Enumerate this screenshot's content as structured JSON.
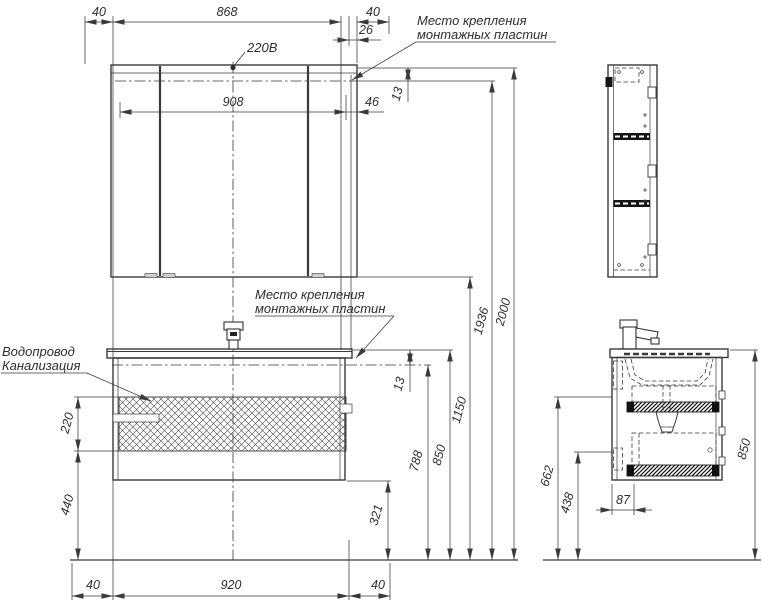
{
  "drawing": {
    "labels": {
      "power": "220В",
      "mounting_top_line1": "Место крепления",
      "mounting_top_line2": "монтажных пластин",
      "mounting_mid_line1": "Место крепления",
      "mounting_mid_line2": "монтажных пластин",
      "water": "Водопровод",
      "sewer": "Канализация"
    },
    "front": {
      "top": {
        "margin_left": "40",
        "plate_span": "868",
        "margin_right": "40",
        "offset": "26",
        "gap": "13",
        "inner_width": "908",
        "side_offset": "46"
      },
      "left": {
        "zone_height": "220",
        "zone_bottom": "440"
      },
      "bottom": {
        "margin_left": "40",
        "width": "920",
        "margin_right": "40"
      },
      "right": {
        "gap": "13",
        "h321": "321",
        "h788": "788",
        "h850": "850",
        "h1150": "1150",
        "h1936": "1936",
        "h2000": "2000"
      }
    },
    "side": {
      "h662": "662",
      "h438": "438",
      "d87": "87",
      "h850": "850"
    },
    "colors": {
      "line": "#3a3a3a",
      "text": "#2e2e2e",
      "background": "#ffffff"
    }
  }
}
